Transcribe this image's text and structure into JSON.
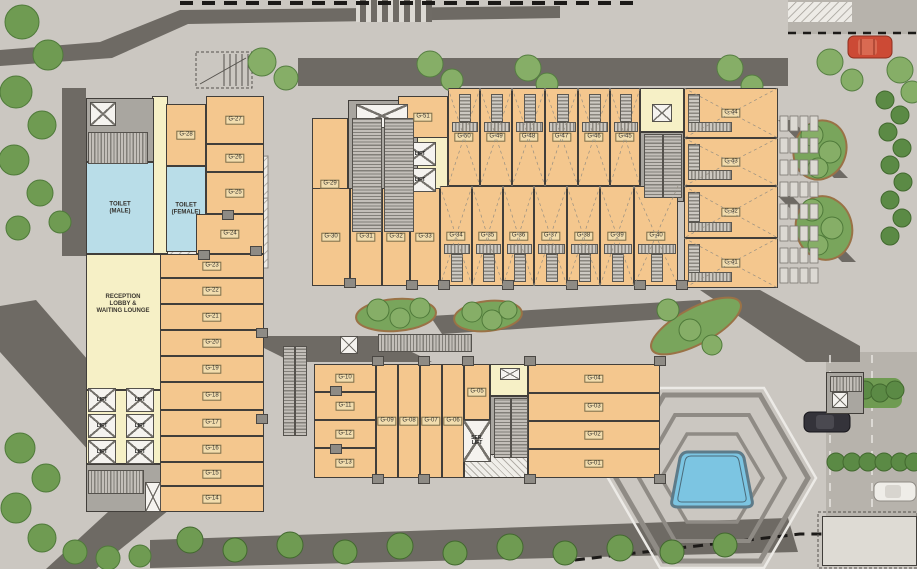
{
  "title": "Ground Floor Site Plan",
  "colors": {
    "shop": "#f4c78e",
    "corridor": "#f6f0c6",
    "toilet": "#b9dde8",
    "core": "#a9a6a0",
    "wall": "#413e3a",
    "plaza": "#cbc7c1",
    "road": "#b7b3ac",
    "shadow": "#6e6a64",
    "green": "#79a55c",
    "pool": "#7cc5e2",
    "label_bg": "#f2ddae",
    "red_car": "#cc4a35",
    "black_car": "#34333a",
    "white_car": "#efede8"
  },
  "texts": {
    "reception": "RECEPTION\nLOBBY &\nWAITING LOUNGE"
  },
  "rooms": [
    {
      "label": "",
      "type": "corridor",
      "x": 152,
      "y": 96,
      "w": 16,
      "h": 158
    },
    {
      "label": "",
      "type": "corridor",
      "x": 86,
      "y": 254,
      "w": 76,
      "h": 136
    },
    {
      "label": "",
      "type": "corridor",
      "x": 86,
      "y": 390,
      "w": 78,
      "h": 74
    },
    {
      "label": "",
      "type": "corridor",
      "x": 414,
      "y": 96,
      "w": 34,
      "h": 168
    },
    {
      "label": "",
      "type": "corridor",
      "x": 640,
      "y": 88,
      "w": 44,
      "h": 44
    },
    {
      "label": "",
      "type": "corridor",
      "x": 490,
      "y": 364,
      "w": 38,
      "h": 32
    },
    {
      "label": "",
      "type": "core",
      "x": 86,
      "y": 98,
      "w": 68,
      "h": 64
    },
    {
      "label": "",
      "type": "core",
      "x": 86,
      "y": 464,
      "w": 78,
      "h": 48
    },
    {
      "label": "",
      "type": "core",
      "x": 348,
      "y": 100,
      "w": 70,
      "h": 164
    },
    {
      "label": "",
      "type": "core",
      "x": 640,
      "y": 132,
      "w": 44,
      "h": 70
    },
    {
      "label": "",
      "type": "core",
      "x": 490,
      "y": 396,
      "w": 38,
      "h": 62
    },
    {
      "label": "",
      "type": "core",
      "x": 826,
      "y": 372,
      "w": 38,
      "h": 42
    },
    {
      "label": "TOILET\n(MALE)",
      "type": "toilet",
      "x": 86,
      "y": 162,
      "w": 68,
      "h": 92
    },
    {
      "label": "TOILET\n(FEMALE)",
      "type": "toilet",
      "x": 166,
      "y": 166,
      "w": 40,
      "h": 86
    },
    {
      "label": "G-28",
      "type": "shop",
      "x": 166,
      "y": 104,
      "w": 40,
      "h": 62
    },
    {
      "label": "G-27",
      "type": "shop",
      "x": 206,
      "y": 96,
      "w": 58,
      "h": 48
    },
    {
      "label": "G-26",
      "type": "shop",
      "x": 206,
      "y": 144,
      "w": 58,
      "h": 28
    },
    {
      "label": "G-25",
      "type": "shop",
      "x": 206,
      "y": 172,
      "w": 58,
      "h": 42
    },
    {
      "label": "G-24",
      "type": "shop",
      "x": 196,
      "y": 214,
      "w": 68,
      "h": 40
    },
    {
      "label": "G-23",
      "type": "shop",
      "x": 160,
      "y": 254,
      "w": 104,
      "h": 24
    },
    {
      "label": "G-22",
      "type": "shop",
      "x": 160,
      "y": 278,
      "w": 104,
      "h": 26
    },
    {
      "label": "G-21",
      "type": "shop",
      "x": 160,
      "y": 304,
      "w": 104,
      "h": 26
    },
    {
      "label": "G-20",
      "type": "shop",
      "x": 160,
      "y": 330,
      "w": 104,
      "h": 26
    },
    {
      "label": "G-19",
      "type": "shop",
      "x": 160,
      "y": 356,
      "w": 104,
      "h": 26
    },
    {
      "label": "G-18",
      "type": "shop",
      "x": 160,
      "y": 382,
      "w": 104,
      "h": 28
    },
    {
      "label": "G-17",
      "type": "shop",
      "x": 160,
      "y": 410,
      "w": 104,
      "h": 26
    },
    {
      "label": "G-16",
      "type": "shop",
      "x": 160,
      "y": 436,
      "w": 104,
      "h": 26
    },
    {
      "label": "G-15",
      "type": "shop",
      "x": 160,
      "y": 462,
      "w": 104,
      "h": 24
    },
    {
      "label": "G-14",
      "type": "shop",
      "x": 160,
      "y": 486,
      "w": 104,
      "h": 26
    },
    {
      "label": "G-29",
      "type": "shop",
      "x": 312,
      "y": 118,
      "w": 36,
      "h": 132
    },
    {
      "label": "G-51",
      "type": "shop",
      "x": 398,
      "y": 96,
      "w": 50,
      "h": 42
    },
    {
      "label": "G-50",
      "type": "shop",
      "x": 448,
      "y": 88,
      "w": 32,
      "h": 98,
      "xm": 1,
      "stair": "top"
    },
    {
      "label": "G-49",
      "type": "shop",
      "x": 480,
      "y": 88,
      "w": 32,
      "h": 98,
      "xm": 1,
      "stair": "top"
    },
    {
      "label": "G-48",
      "type": "shop",
      "x": 512,
      "y": 88,
      "w": 33,
      "h": 98,
      "xm": 1,
      "stair": "top"
    },
    {
      "label": "G-47",
      "type": "shop",
      "x": 545,
      "y": 88,
      "w": 33,
      "h": 98,
      "xm": 1,
      "stair": "top"
    },
    {
      "label": "G-46",
      "type": "shop",
      "x": 578,
      "y": 88,
      "w": 32,
      "h": 98,
      "xm": 1,
      "stair": "top"
    },
    {
      "label": "G-45",
      "type": "shop",
      "x": 610,
      "y": 88,
      "w": 30,
      "h": 98,
      "xm": 1,
      "stair": "top"
    },
    {
      "label": "G-44",
      "type": "shop",
      "x": 684,
      "y": 88,
      "w": 94,
      "h": 50,
      "xm": 1,
      "stair": "left"
    },
    {
      "label": "G-43",
      "type": "shop",
      "x": 684,
      "y": 138,
      "w": 94,
      "h": 48,
      "xm": 1,
      "stair": "left"
    },
    {
      "label": "G-30",
      "type": "shop",
      "x": 312,
      "y": 188,
      "w": 38,
      "h": 98
    },
    {
      "label": "G-31",
      "type": "shop",
      "x": 350,
      "y": 188,
      "w": 32,
      "h": 98
    },
    {
      "label": "G-32",
      "type": "shop",
      "x": 382,
      "y": 188,
      "w": 28,
      "h": 98
    },
    {
      "label": "G-33",
      "type": "shop",
      "x": 410,
      "y": 188,
      "w": 30,
      "h": 98
    },
    {
      "label": "G-34",
      "type": "shop",
      "x": 440,
      "y": 186,
      "w": 32,
      "h": 100,
      "xm": 1,
      "stair": "bottom"
    },
    {
      "label": "G-35",
      "type": "shop",
      "x": 472,
      "y": 186,
      "w": 31,
      "h": 100,
      "xm": 1,
      "stair": "bottom"
    },
    {
      "label": "G-36",
      "type": "shop",
      "x": 503,
      "y": 186,
      "w": 31,
      "h": 100,
      "xm": 1,
      "stair": "bottom"
    },
    {
      "label": "G-37",
      "type": "shop",
      "x": 534,
      "y": 186,
      "w": 33,
      "h": 100,
      "xm": 1,
      "stair": "bottom"
    },
    {
      "label": "G-38",
      "type": "shop",
      "x": 567,
      "y": 186,
      "w": 33,
      "h": 100,
      "xm": 1,
      "stair": "bottom"
    },
    {
      "label": "G-39",
      "type": "shop",
      "x": 600,
      "y": 186,
      "w": 34,
      "h": 100,
      "xm": 1,
      "stair": "bottom"
    },
    {
      "label": "G-40",
      "type": "shop",
      "x": 634,
      "y": 186,
      "w": 44,
      "h": 100,
      "xm": 1,
      "stair": "bottom"
    },
    {
      "label": "G-42",
      "type": "shop",
      "x": 684,
      "y": 186,
      "w": 94,
      "h": 52,
      "xm": 1,
      "stair": "left"
    },
    {
      "label": "G-41",
      "type": "shop",
      "x": 684,
      "y": 238,
      "w": 94,
      "h": 50,
      "xm": 1,
      "stair": "left"
    },
    {
      "label": "G-10",
      "type": "shop",
      "x": 314,
      "y": 364,
      "w": 62,
      "h": 28
    },
    {
      "label": "G-11",
      "type": "shop",
      "x": 314,
      "y": 392,
      "w": 62,
      "h": 28
    },
    {
      "label": "G-12",
      "type": "shop",
      "x": 314,
      "y": 420,
      "w": 62,
      "h": 28
    },
    {
      "label": "G-13",
      "type": "shop",
      "x": 314,
      "y": 448,
      "w": 62,
      "h": 30
    },
    {
      "label": "G-09",
      "type": "shop",
      "x": 376,
      "y": 364,
      "w": 22,
      "h": 114
    },
    {
      "label": "G-08",
      "type": "shop",
      "x": 398,
      "y": 364,
      "w": 22,
      "h": 114
    },
    {
      "label": "G-07",
      "type": "shop",
      "x": 420,
      "y": 364,
      "w": 22,
      "h": 114
    },
    {
      "label": "G-06",
      "type": "shop",
      "x": 442,
      "y": 364,
      "w": 22,
      "h": 114
    },
    {
      "label": "G-05",
      "type": "shop",
      "x": 464,
      "y": 364,
      "w": 26,
      "h": 56
    },
    {
      "label": "G-04",
      "type": "shop",
      "x": 528,
      "y": 364,
      "w": 132,
      "h": 29
    },
    {
      "label": "G-03",
      "type": "shop",
      "x": 528,
      "y": 393,
      "w": 132,
      "h": 28
    },
    {
      "label": "G-02",
      "type": "shop",
      "x": 528,
      "y": 421,
      "w": 132,
      "h": 28
    },
    {
      "label": "G-01",
      "type": "shop",
      "x": 528,
      "y": 449,
      "w": 132,
      "h": 29
    },
    {
      "label": "",
      "type": "hatch",
      "x": 464,
      "y": 454,
      "w": 64,
      "h": 24
    },
    {
      "label": "",
      "type": "plain",
      "x": 822,
      "y": 516,
      "w": 95,
      "h": 50
    }
  ],
  "lifts": [
    {
      "label": "LIFT",
      "x": 88,
      "y": 388,
      "w": 28,
      "h": 24
    },
    {
      "label": "LIFT",
      "x": 88,
      "y": 414,
      "w": 28,
      "h": 24
    },
    {
      "label": "LIFT",
      "x": 88,
      "y": 440,
      "w": 28,
      "h": 24
    },
    {
      "label": "LIFT",
      "x": 126,
      "y": 388,
      "w": 28,
      "h": 24
    },
    {
      "label": "LIFT",
      "x": 126,
      "y": 414,
      "w": 28,
      "h": 24
    },
    {
      "label": "LIFT",
      "x": 126,
      "y": 440,
      "w": 28,
      "h": 24
    },
    {
      "label": "LIFT",
      "x": 404,
      "y": 142,
      "w": 32,
      "h": 24
    },
    {
      "label": "LIFT",
      "x": 404,
      "y": 168,
      "w": 32,
      "h": 24
    },
    {
      "label": "SER.\nLIFT",
      "x": 463,
      "y": 420,
      "w": 28,
      "h": 42
    },
    {
      "label": "",
      "x": 90,
      "y": 102,
      "w": 26,
      "h": 24
    },
    {
      "label": "",
      "x": 356,
      "y": 104,
      "w": 52,
      "h": 24
    },
    {
      "label": "",
      "x": 652,
      "y": 104,
      "w": 20,
      "h": 18
    },
    {
      "label": "",
      "x": 145,
      "y": 482,
      "w": 16,
      "h": 30
    },
    {
      "label": "",
      "x": 340,
      "y": 336,
      "w": 18,
      "h": 18
    },
    {
      "label": "",
      "x": 832,
      "y": 392,
      "w": 16,
      "h": 16
    },
    {
      "label": "",
      "x": 500,
      "y": 368,
      "w": 20,
      "h": 12
    }
  ]
}
